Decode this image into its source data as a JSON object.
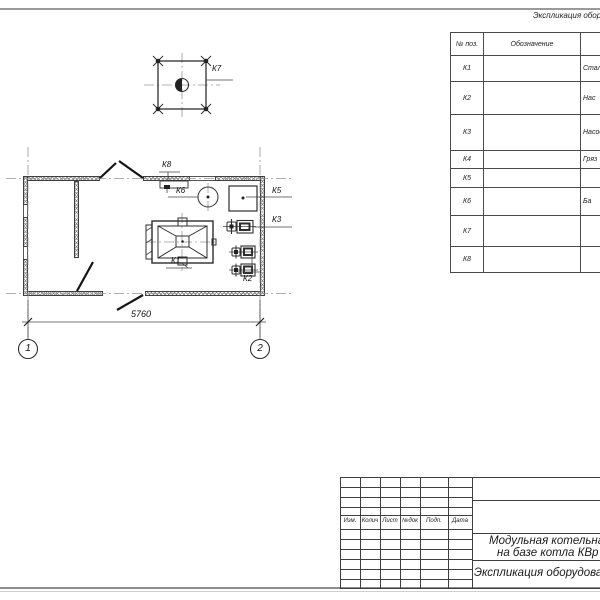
{
  "colors": {
    "line": "#3f3f3f",
    "hatch": "#777777",
    "page_edge": "#9a9a9a"
  },
  "equipment_table": {
    "title": "Экспликация оборудования",
    "columns": [
      "№ поз.",
      "Обозначение"
    ],
    "rows": [
      {
        "pos": "К1",
        "name": "Стальной"
      },
      {
        "pos": "К2",
        "name": "Нас"
      },
      {
        "pos": "К3",
        "name": "Насос"
      },
      {
        "pos": "К4",
        "name": "Гряз"
      },
      {
        "pos": "К5",
        "name": ""
      },
      {
        "pos": "К6",
        "name": "Ба"
      },
      {
        "pos": "К7",
        "name": ""
      },
      {
        "pos": "К8",
        "name": ""
      }
    ]
  },
  "plan": {
    "dimension": "5760",
    "axis_labels": [
      "1",
      "2"
    ],
    "tags": {
      "k1": "К1",
      "k2": "К2",
      "k3": "К3",
      "k5": "К5",
      "k6": "К6",
      "k7": "К7",
      "k8": "К8"
    }
  },
  "title_block": {
    "revision_columns": [
      "Изм.",
      "Колич",
      "Лист",
      "№док",
      "Подп.",
      "Дата"
    ],
    "project_title_line1": "Модульная котельная",
    "project_title_line2": "на базе котла КВр",
    "sheet_title": "Экспликация оборудования"
  }
}
